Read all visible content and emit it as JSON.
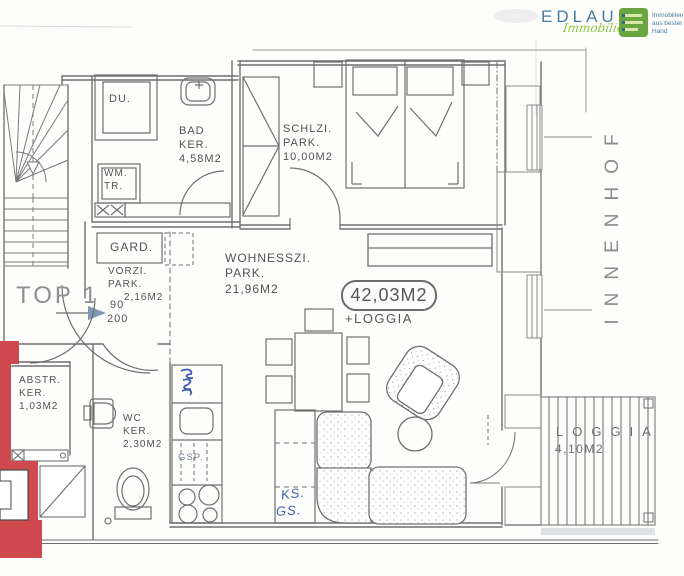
{
  "logo": {
    "brand": "EDLAUER",
    "script": "Immobilien",
    "tagline_line1": "Immobilien",
    "tagline_line2": "aus bester",
    "tagline_line3": "Hand"
  },
  "courtyard_label": "INNENHOF",
  "unit": {
    "label": "TOP 1",
    "area_badge": "42,03M2",
    "area_badge_suffix": "+LOGGIA",
    "entry_door_width": "90",
    "entry_door_height": "200"
  },
  "rooms": {
    "shower": {
      "label": "DU."
    },
    "bath": {
      "line1": "BAD",
      "line2": "KER.",
      "line3": "4,58M2"
    },
    "laundry": {
      "line1": "WM.",
      "line2": "TR."
    },
    "bedroom": {
      "line1": "SCHLZI.",
      "line2": "PARK.",
      "line3": "10,00M2"
    },
    "wardrobe_label": "GARD.",
    "hallway": {
      "line1": "VORZI.",
      "line2": "PARK.",
      "line3": "2,16M2"
    },
    "living": {
      "line1": "WOHNESSZI.",
      "line2": "PARK.",
      "line3": "21,96M2"
    },
    "storage": {
      "line1": "ABSTR.",
      "line2": "KER.",
      "line3": "1,03M2"
    },
    "wc": {
      "line1": "WC",
      "line2": "KER.",
      "line3": "2,30M2"
    },
    "loggia": {
      "line1": "LOGGIA",
      "line2": "4,10M2"
    }
  },
  "appliances": {
    "dishwasher": "GSP.",
    "fridge": "KS.",
    "freezer": "GS."
  },
  "colors": {
    "highlight_red": "#d0494e",
    "brand_blue": "#4b7c9e",
    "brand_green": "#8bc43c",
    "ink_blue": "#3f5fae",
    "line_gray": "#6f6f6f"
  }
}
